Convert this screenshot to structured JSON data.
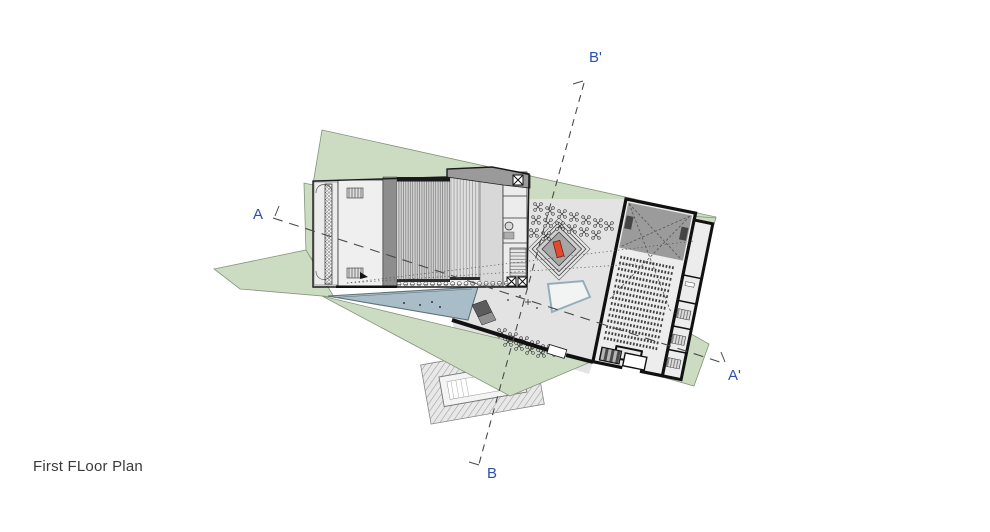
{
  "page": {
    "background": "#ffffff"
  },
  "title": {
    "label": "First FLoor Plan"
  },
  "sections": {
    "a": {
      "start_label": "A",
      "end_label": "A'"
    },
    "b": {
      "start_label": "B",
      "end_label": "B'"
    }
  },
  "colors": {
    "site_green": "#ccdcc2",
    "site_edge": "#85957c",
    "water": "#a8bdc8",
    "water_edge": "#5f7077",
    "building_fill": "#ededed",
    "courtyard_fill": "#e3e3e3",
    "corridor_dark": "#8d8d8d",
    "stage_gray": "#9b9b9b",
    "roof_band": "#9a9a9a",
    "monument_red": "#e04b30",
    "section_label_blue": "#2b50a8",
    "wall_black": "#151515",
    "title_color": "#3a3a3a"
  },
  "features": {
    "monument": "stepped-diamond-plinth-with-red-sculpture",
    "upper_terrace_tables": 15,
    "lower_terrace_tables": 10,
    "auditorium_seat_rows": 15,
    "stage_front_seats": 17,
    "water_features": 2
  }
}
